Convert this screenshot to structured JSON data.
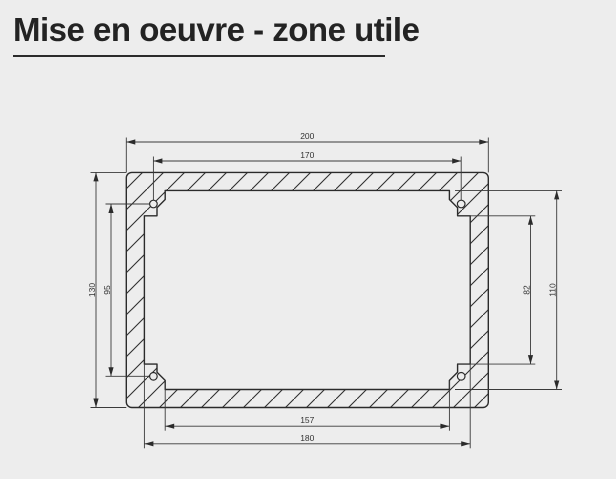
{
  "page": {
    "title": "Mise en oeuvre - zone utile",
    "background_color": "#ededed",
    "line_color": "#2b2b2b",
    "title_color": "#232323"
  },
  "drawing": {
    "type": "technical-dimension-drawing",
    "subject": "rectangular mounting frame (useful zone) with hatched wall section, four chamfered corner tabs and screw holes",
    "units_per_px": 0.5525,
    "dimensions": {
      "outer_width": "200",
      "top_hole_spacing": "170",
      "outer_height": "130",
      "left_hole_spacing": "95",
      "right_tab_clearance": "82",
      "inner_height": "110",
      "bottom_tab_clearance": "157",
      "inner_width": "180"
    },
    "dimension_notes": {
      "outer_width": "total outer width, top dimension line",
      "top_hole_spacing": "horizontal distance between upper screw-hole centers",
      "outer_height": "total outer height, left dimension line",
      "left_hole_spacing": "vertical distance between screw-hole centers",
      "right_tab_clearance": "vertical clearance between corner tabs",
      "inner_height": "inner opening height",
      "bottom_tab_clearance": "horizontal clearance between corner tabs",
      "inner_width": "inner opening width"
    },
    "screw_holes": 4
  }
}
